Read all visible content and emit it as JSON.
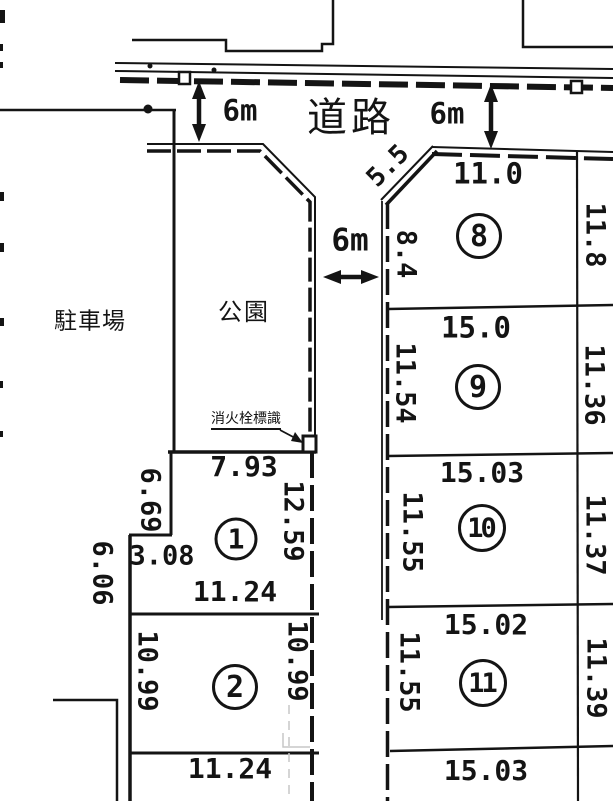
{
  "map": {
    "background": "#ffffff",
    "ink": "#141414",
    "road_label": "道路",
    "parking_label": "駐車場",
    "park_label": "公園",
    "fire_hydrant_label": "消火栓標識",
    "road_width_top_left": "6m",
    "road_width_top_right": "6m",
    "road_width_center": "6m"
  },
  "plots": [
    {
      "number": "1",
      "dims": {
        "top": "7.93",
        "left": "6.69",
        "right": "12.59",
        "step": "3.08",
        "bottom": "11.24",
        "outer_left": "6.06"
      }
    },
    {
      "number": "2",
      "dims": {
        "left": "10.99",
        "right": "10.99",
        "bottom": "11.24"
      }
    },
    {
      "number": "8",
      "dims": {
        "top": "11.0",
        "left": "8.4",
        "right": "11.8",
        "chamfer": "5.5"
      }
    },
    {
      "number": "9",
      "dims": {
        "top": "15.0",
        "left": "11.54",
        "right": "11.36"
      }
    },
    {
      "number": "10",
      "dims": {
        "top": "15.03",
        "left": "11.55",
        "right": "11.37"
      }
    },
    {
      "number": "11",
      "dims": {
        "top": "15.02",
        "left": "11.55",
        "right": "11.39",
        "bottom": "15.03"
      }
    }
  ]
}
